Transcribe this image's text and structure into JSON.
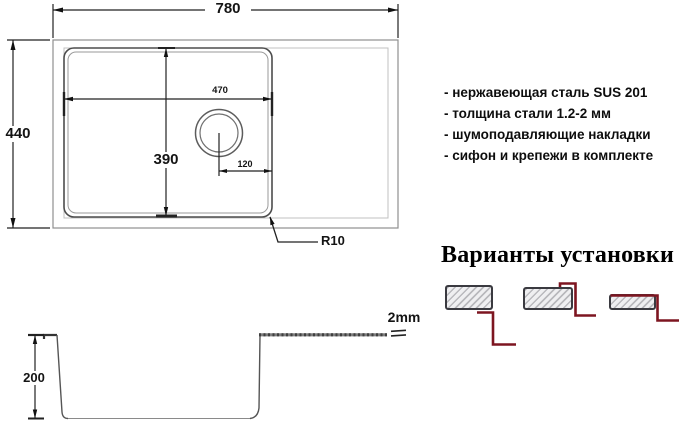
{
  "top_view": {
    "overall_width": "780",
    "overall_depth": "440",
    "bowl_width": "470",
    "bowl_depth": "390",
    "drain_offset": "120",
    "corner_radius": "R10"
  },
  "section_view": {
    "bowl_depth": "200",
    "steel_thickness": "2mm"
  },
  "features": [
    "- нержавеющая сталь SUS 201",
    "- толщина стали 1.2-2 мм",
    "- шумоподавляющие накладки",
    "- сифон и крепежи в комплекте"
  ],
  "installation": {
    "title": "Варианты установки"
  },
  "colors": {
    "line": "#2a2a2a",
    "profile_red": "#7d1520",
    "hatch_gray": "#b9b9bd"
  }
}
